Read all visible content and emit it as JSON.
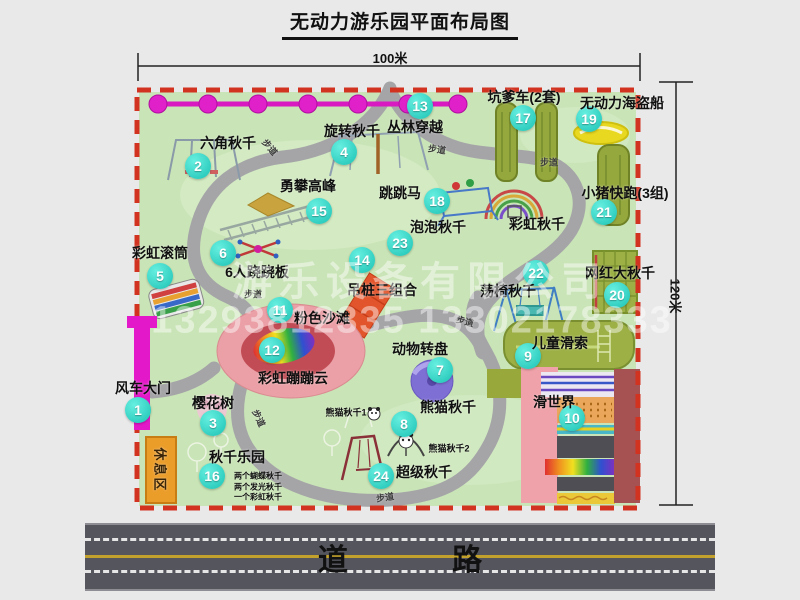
{
  "title": "无动力游乐园平面布局图",
  "dimensions": {
    "width_label": "100米",
    "height_label": "120米"
  },
  "watermark": {
    "company": "游乐设备有限公司",
    "phone": "13293812335 13302178333"
  },
  "road": {
    "label": "道 路"
  },
  "colors": {
    "marker_cyan": "#27d2c2",
    "park_ground": "#c9e4b6",
    "park_border_red": "#d23220",
    "walkway_gray": "#a5a5a8",
    "gate_magenta": "#e318c8",
    "rest_area_orange": "#eb9d2a",
    "road_dark": "#55555d",
    "pink_beach": "#eaa0a6",
    "equipment_olive": "#95a83d"
  },
  "attractions": [
    {
      "num": "1",
      "label": "风车大门",
      "marker": [
        138,
        410
      ],
      "label_at": [
        143,
        388
      ]
    },
    {
      "num": "2",
      "label": "六角秋千",
      "marker": [
        198,
        166
      ],
      "label_at": [
        228,
        143
      ]
    },
    {
      "num": "3",
      "label": "樱花树",
      "marker": [
        213,
        423
      ],
      "label_at": [
        213,
        403
      ]
    },
    {
      "num": "4",
      "label": "旋转秋千",
      "marker": [
        344,
        152
      ],
      "label_at": [
        352,
        131
      ]
    },
    {
      "num": "5",
      "label": "彩虹滚筒",
      "marker": [
        160,
        276
      ],
      "label_at": [
        160,
        253
      ]
    },
    {
      "num": "6",
      "label": "6人跷跷板",
      "marker": [
        223,
        253
      ],
      "label_at": [
        257,
        272
      ]
    },
    {
      "num": "7",
      "label": "动物转盘",
      "marker": [
        440,
        370
      ],
      "label_at": [
        420,
        349
      ]
    },
    {
      "num": "8",
      "label": "熊猫秋千",
      "marker": [
        404,
        424
      ],
      "label_at": [
        448,
        407
      ]
    },
    {
      "num": "9",
      "label": "儿童滑索",
      "marker": [
        528,
        356
      ],
      "label_at": [
        560,
        343
      ]
    },
    {
      "num": "10",
      "label": "滑世界",
      "marker": [
        572,
        418
      ],
      "label_at": [
        554,
        402
      ]
    },
    {
      "num": "11",
      "label": "粉色沙滩",
      "marker": [
        280,
        310
      ],
      "label_at": [
        322,
        318
      ]
    },
    {
      "num": "12",
      "label": "彩虹蹦蹦云",
      "marker": [
        272,
        350
      ],
      "label_at": [
        293,
        378
      ]
    },
    {
      "num": "13",
      "label": "丛林穿越",
      "marker": [
        420,
        106
      ],
      "label_at": [
        415,
        127
      ]
    },
    {
      "num": "14",
      "label": "吊桩三组合",
      "marker": [
        362,
        260
      ],
      "label_at": [
        382,
        290
      ]
    },
    {
      "num": "15",
      "label": "勇攀高峰",
      "marker": [
        319,
        211
      ],
      "label_at": [
        308,
        186
      ]
    },
    {
      "num": "16",
      "label": "秋千乐园",
      "marker": [
        212,
        476
      ],
      "label_at": [
        237,
        457
      ]
    },
    {
      "num": "17",
      "label": "坑爹车(2套)",
      "marker": [
        523,
        118
      ],
      "label_at": [
        524,
        97
      ]
    },
    {
      "num": "18",
      "label": "跳跳马",
      "marker": [
        437,
        201
      ],
      "label_at": [
        400,
        193
      ]
    },
    {
      "num": "19",
      "label": "无动力海盗船",
      "marker": [
        589,
        119
      ],
      "label_at": [
        622,
        103
      ]
    },
    {
      "num": "20",
      "label": "网红大秋千",
      "marker": [
        617,
        295
      ],
      "label_at": [
        620,
        273
      ]
    },
    {
      "num": "21",
      "label": "小猪快跑(3组)",
      "marker": [
        604,
        212
      ],
      "label_at": [
        625,
        193
      ]
    },
    {
      "num": "22",
      "label": "荡椅秋千",
      "marker": [
        536,
        273
      ],
      "label_at": [
        508,
        291
      ]
    },
    {
      "num": "23",
      "label": "泡泡秋千",
      "marker": [
        400,
        243
      ],
      "label_at": [
        438,
        227
      ]
    },
    {
      "num": "24",
      "label": "超级秋千",
      "marker": [
        381,
        476
      ],
      "label_at": [
        424,
        472
      ]
    }
  ],
  "extra_labels": [
    {
      "text": "彩虹秋千",
      "at": [
        537,
        224
      ],
      "size": 14,
      "name": "label-rainbow-swing"
    },
    {
      "text": "休息区",
      "at": [
        161,
        470
      ],
      "size": 13,
      "rot": 90,
      "cls": "rest",
      "name": "label-rest-area"
    },
    {
      "text": "熊猫秋千1",
      "at": [
        346,
        412
      ],
      "size": 9,
      "name": "label-panda-swing-1"
    },
    {
      "text": "熊猫秋千2",
      "at": [
        449,
        448
      ],
      "size": 9,
      "name": "label-panda-swing-2"
    },
    {
      "text": "两个蝴蝶秋千",
      "at": [
        258,
        476
      ],
      "size": 8,
      "name": "label-swing-note-1"
    },
    {
      "text": "两个发光秋千",
      "at": [
        258,
        487
      ],
      "size": 8,
      "name": "label-swing-note-2"
    },
    {
      "text": "一个彩虹秋千",
      "at": [
        258,
        497
      ],
      "size": 8,
      "name": "label-swing-note-3"
    },
    {
      "text": "步道",
      "at": [
        270,
        147
      ],
      "size": 9,
      "rot": 50,
      "cls": "path",
      "name": "label-walkway"
    },
    {
      "text": "步道",
      "at": [
        437,
        149
      ],
      "size": 9,
      "rot": 8,
      "cls": "path",
      "name": "label-walkway"
    },
    {
      "text": "步道",
      "at": [
        549,
        162
      ],
      "size": 9,
      "rot": 0,
      "cls": "path",
      "name": "label-walkway"
    },
    {
      "text": "步道",
      "at": [
        253,
        294
      ],
      "size": 9,
      "rot": 0,
      "cls": "path",
      "name": "label-walkway"
    },
    {
      "text": "步道",
      "at": [
        465,
        321
      ],
      "size": 9,
      "rot": 15,
      "cls": "path",
      "name": "label-walkway"
    },
    {
      "text": "步道",
      "at": [
        259,
        418
      ],
      "size": 9,
      "rot": 65,
      "cls": "path",
      "name": "label-walkway"
    },
    {
      "text": "步道",
      "at": [
        385,
        497
      ],
      "size": 9,
      "rot": -8,
      "cls": "path",
      "name": "label-walkway"
    }
  ]
}
